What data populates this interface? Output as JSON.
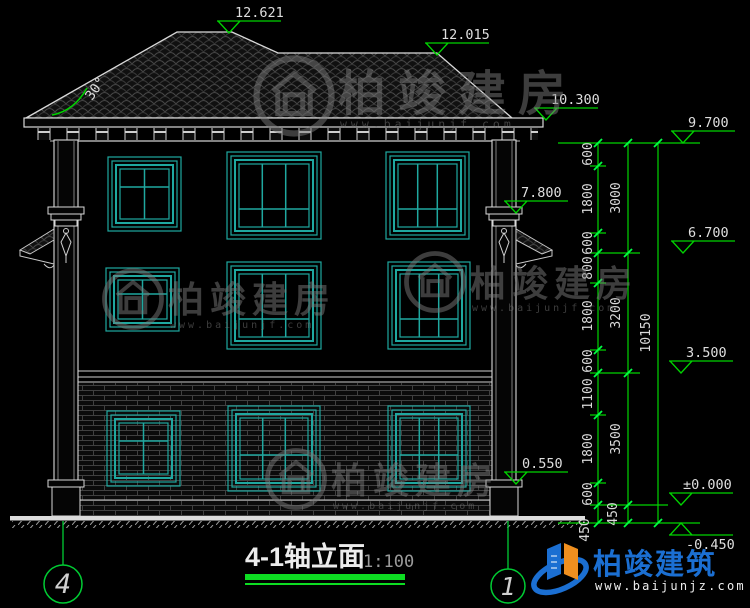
{
  "title": {
    "text": "4-1轴立面",
    "scale": "1:100"
  },
  "axes": {
    "left": "4",
    "right": "1"
  },
  "roof": {
    "angle": "30°"
  },
  "levels": {
    "ridge_main": "12.621",
    "ridge_secondary": "12.015",
    "eave": "10.300",
    "plate": "9.700",
    "canopy": "7.800",
    "floor3": "6.700",
    "floor2": "3.500",
    "sill": "0.550",
    "zero": "±0.000",
    "site": "-0.450"
  },
  "dims": {
    "chain1": [
      "600",
      "1800",
      "600",
      "800",
      "1800",
      "600",
      "1100",
      "1800",
      "600",
      "450"
    ],
    "chain2": [
      "3000",
      "3200",
      "3500",
      "450"
    ],
    "total": "10150"
  },
  "watermark": {
    "brand": "柏竣建房",
    "url": "www.baijunjf.com"
  },
  "brand_footer": {
    "name": "柏竣建筑",
    "url": "www.baijunjz.com"
  },
  "colors": {
    "background": "#000000",
    "line": "#d9d9d9",
    "dimension_green": "#00d400",
    "window_teal": "#1fa8a0",
    "brand_blue": "#1b6fd2",
    "brand_orange": "#ef8f1f",
    "watermark_gray": "#7a7a7a"
  }
}
